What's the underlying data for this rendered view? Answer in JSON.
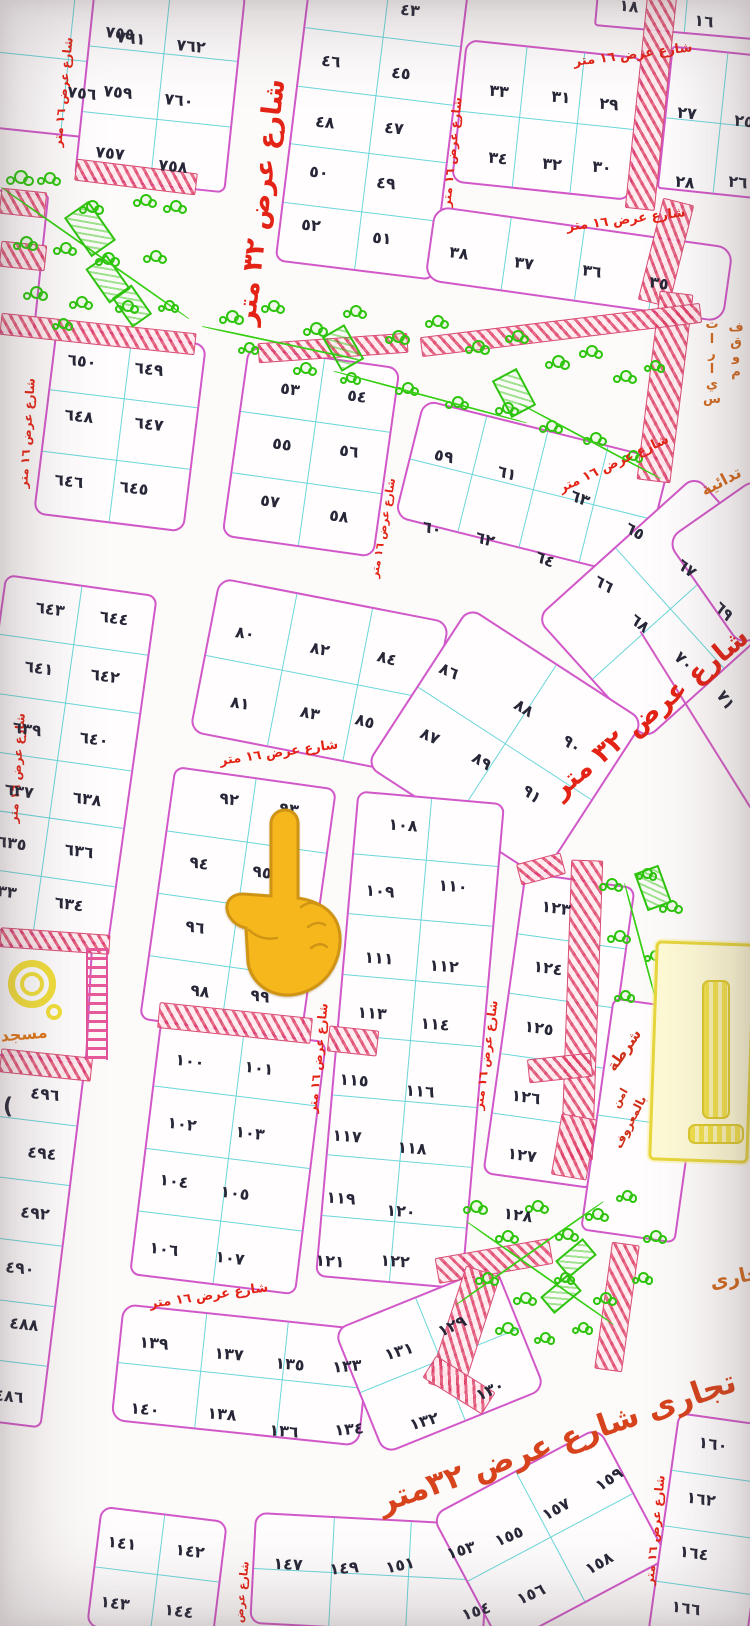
{
  "map": {
    "title": "subdivision-plot-map",
    "colors": {
      "plot_border": "#d158c8",
      "grid_line": "#6bd6da",
      "number": "#272738",
      "street_text": "#e32315",
      "street_text_big": "#d6431c",
      "amenity_text": "#d2691e",
      "hatch": "#de3a62",
      "park_green": "#2ec40e",
      "mosque_yellow": "#f3e03a",
      "hand_yellow": "#f5b71c"
    },
    "hand_icon": {
      "name": "backhand-index-pointing-up",
      "x": 225,
      "y": 806
    },
    "street_labels": [
      {
        "text": "شارع عرض ١٦ متر",
        "x": 63,
        "y": 92,
        "r": -84,
        "size": 12
      },
      {
        "text": "شارع عرض ٣٢ متر",
        "x": 261,
        "y": 202,
        "r": -83,
        "size": 27
      },
      {
        "text": "شارع عرض ١٦ متر",
        "x": 452,
        "y": 152,
        "r": -84,
        "size": 12
      },
      {
        "text": "شارع عرض ١٦ متر",
        "x": 633,
        "y": 55,
        "r": -7,
        "size": 13
      },
      {
        "text": "شارع عرض ١٦ متر",
        "x": 626,
        "y": 220,
        "r": -7,
        "size": 13
      },
      {
        "text": "شارع عرض ١٦ متر",
        "x": 27,
        "y": 433,
        "r": -86,
        "size": 12
      },
      {
        "text": "شارع عرض ١٦ متر",
        "x": 614,
        "y": 464,
        "r": -25,
        "size": 13
      },
      {
        "text": "شارع عرض ١٦ متر",
        "x": 383,
        "y": 528,
        "r": -80,
        "size": 11
      },
      {
        "text": "شارع عرض ٣٢ متر",
        "x": 650,
        "y": 713,
        "r": -40,
        "size": 27
      },
      {
        "text": "شارع عرض ١٦ متر",
        "x": 17,
        "y": 768,
        "r": -86,
        "size": 12
      },
      {
        "text": "شارع عرض ١٦ متر",
        "x": 279,
        "y": 753,
        "r": -8,
        "size": 13
      },
      {
        "text": "شارع عرض ١٦ متر",
        "x": 318,
        "y": 1058,
        "r": -84,
        "size": 12
      },
      {
        "text": "شارع عرض ١٦ متر",
        "x": 486,
        "y": 1055,
        "r": -82,
        "size": 12
      },
      {
        "text": "شارع عرض ١٦ متر",
        "x": 209,
        "y": 1296,
        "r": -8,
        "size": 13
      },
      {
        "text": "شارع عرض",
        "x": 242,
        "y": 1592,
        "r": -84,
        "size": 11
      },
      {
        "text": "شارع عرض ١٦ متر",
        "x": 655,
        "y": 1530,
        "r": -84,
        "size": 12
      },
      {
        "text": "تجارى شارع عرض ٣٢متر",
        "x": 557,
        "y": 1442,
        "r": -19,
        "size": 31,
        "color": "#d6431c"
      }
    ],
    "area_labels": [
      {
        "text": "موقف",
        "x": 736,
        "y": 350,
        "stack": true,
        "size": 13,
        "color": "#d2691e"
      },
      {
        "text": "سيارات",
        "x": 712,
        "y": 362,
        "stack": true,
        "size": 13,
        "color": "#d2691e"
      },
      {
        "text": "تدائية",
        "x": 721,
        "y": 481,
        "r": -28,
        "size": 16,
        "color": "#d2691e"
      },
      {
        "text": "مسجد",
        "x": 24,
        "y": 1034,
        "r": -5,
        "size": 16,
        "color": "#e07818"
      },
      {
        "text": "شرطة",
        "x": 624,
        "y": 1050,
        "r": -55,
        "size": 15,
        "color": "#d03018"
      },
      {
        "text": "امن",
        "x": 620,
        "y": 1098,
        "r": -60,
        "size": 11,
        "color": "#d03018"
      },
      {
        "text": "بالمعروف",
        "x": 630,
        "y": 1122,
        "r": -63,
        "size": 12,
        "color": "#d03018"
      },
      {
        "text": "تجارى",
        "x": 739,
        "y": 1276,
        "r": -12,
        "size": 20,
        "color": "#d2691e"
      },
      {
        "text": "(",
        "x": 8,
        "y": 1107,
        "r": 0,
        "size": 22,
        "color": "#272738"
      }
    ],
    "plots": [
      {
        "label": "٧٥٥",
        "x": 120,
        "y": 33,
        "r": 6
      },
      {
        "label": "٧٥٦",
        "x": 82,
        "y": 93,
        "r": 6
      },
      {
        "label": "٧٦١",
        "x": 131,
        "y": 38,
        "r": 6
      },
      {
        "label": "٧٦٢",
        "x": 191,
        "y": 46,
        "r": 6
      },
      {
        "label": "٧٥٩",
        "x": 118,
        "y": 92,
        "r": 6
      },
      {
        "label": "٧٦٠",
        "x": 179,
        "y": 100,
        "r": 6
      },
      {
        "label": "٧٥٧",
        "x": 110,
        "y": 153,
        "r": 6
      },
      {
        "label": "٧٥٨",
        "x": 173,
        "y": 166,
        "r": 6
      },
      {
        "label": "٤٣",
        "x": 410,
        "y": 10,
        "r": 6
      },
      {
        "label": "٤٥",
        "x": 401,
        "y": 73,
        "r": 6
      },
      {
        "label": "٤٧",
        "x": 394,
        "y": 128,
        "r": 6
      },
      {
        "label": "٤٩",
        "x": 386,
        "y": 183,
        "r": 6
      },
      {
        "label": "٥١",
        "x": 382,
        "y": 238,
        "r": 6
      },
      {
        "label": "٤٦",
        "x": 331,
        "y": 61,
        "r": 6
      },
      {
        "label": "٤٨",
        "x": 325,
        "y": 122,
        "r": 6
      },
      {
        "label": "٥٠",
        "x": 319,
        "y": 172,
        "r": 6
      },
      {
        "label": "٥٢",
        "x": 311,
        "y": 225,
        "r": 6
      },
      {
        "label": "٣٣",
        "x": 499,
        "y": 91,
        "r": 6
      },
      {
        "label": "٣١",
        "x": 561,
        "y": 97,
        "r": 6
      },
      {
        "label": "٢٩",
        "x": 609,
        "y": 104,
        "r": 6
      },
      {
        "label": "٣٤",
        "x": 498,
        "y": 158,
        "r": 6
      },
      {
        "label": "٣٢",
        "x": 552,
        "y": 164,
        "r": 6
      },
      {
        "label": "٣٠",
        "x": 602,
        "y": 167,
        "r": 6
      },
      {
        "label": "٢٧",
        "x": 687,
        "y": 113,
        "r": 6
      },
      {
        "label": "٢٥",
        "x": 744,
        "y": 121,
        "r": 6
      },
      {
        "label": "٢٨",
        "x": 685,
        "y": 182,
        "r": 6
      },
      {
        "label": "٢٦",
        "x": 738,
        "y": 182,
        "r": 6
      },
      {
        "label": "١٨",
        "x": 629,
        "y": 6,
        "r": 6
      },
      {
        "label": "١٦",
        "x": 704,
        "y": 21,
        "r": 6
      },
      {
        "label": "٣٨",
        "x": 459,
        "y": 253,
        "r": 8
      },
      {
        "label": "٣٧",
        "x": 524,
        "y": 263,
        "r": 8
      },
      {
        "label": "٣٦",
        "x": 592,
        "y": 271,
        "r": 8
      },
      {
        "label": "٣٥",
        "x": 659,
        "y": 283,
        "r": 8
      },
      {
        "label": "٦٥٠",
        "x": 82,
        "y": 361,
        "r": 7
      },
      {
        "label": "٦٤٩",
        "x": 149,
        "y": 369,
        "r": 7
      },
      {
        "label": "٦٤٨",
        "x": 79,
        "y": 416,
        "r": 7
      },
      {
        "label": "٦٤٧",
        "x": 149,
        "y": 424,
        "r": 7
      },
      {
        "label": "٦٤٦",
        "x": 69,
        "y": 481,
        "r": 7
      },
      {
        "label": "٦٤٥",
        "x": 134,
        "y": 488,
        "r": 7
      },
      {
        "label": "٥٣",
        "x": 290,
        "y": 389,
        "r": 8
      },
      {
        "label": "٥٤",
        "x": 357,
        "y": 396,
        "r": 8
      },
      {
        "label": "٥٥",
        "x": 282,
        "y": 444,
        "r": 8
      },
      {
        "label": "٥٦",
        "x": 349,
        "y": 451,
        "r": 8
      },
      {
        "label": "٥٧",
        "x": 270,
        "y": 501,
        "r": 8
      },
      {
        "label": "٥٨",
        "x": 339,
        "y": 516,
        "r": 8
      },
      {
        "label": "٥٩",
        "x": 444,
        "y": 456,
        "r": 12
      },
      {
        "label": "٦١",
        "x": 507,
        "y": 473,
        "r": 16
      },
      {
        "label": "٦٣",
        "x": 580,
        "y": 498,
        "r": 22
      },
      {
        "label": "٦٥",
        "x": 635,
        "y": 531,
        "r": 30
      },
      {
        "label": "٦٧",
        "x": 687,
        "y": 568,
        "r": 38
      },
      {
        "label": "٦٩",
        "x": 724,
        "y": 611,
        "r": 45
      },
      {
        "label": "٧١",
        "x": 726,
        "y": 700,
        "r": 55
      },
      {
        "label": "٦٠",
        "x": 432,
        "y": 528,
        "r": 12
      },
      {
        "label": "٦٢",
        "x": 485,
        "y": 539,
        "r": 16
      },
      {
        "label": "٦٤",
        "x": 545,
        "y": 559,
        "r": 22
      },
      {
        "label": "٦٦",
        "x": 604,
        "y": 584,
        "r": 30
      },
      {
        "label": "٦٨",
        "x": 640,
        "y": 623,
        "r": 38
      },
      {
        "label": "٧٠",
        "x": 684,
        "y": 661,
        "r": 45
      },
      {
        "label": "٦٤٣",
        "x": 50,
        "y": 609,
        "r": 8
      },
      {
        "label": "٦٤٤",
        "x": 114,
        "y": 618,
        "r": 8
      },
      {
        "label": "٦٤١",
        "x": 39,
        "y": 668,
        "r": 8
      },
      {
        "label": "٦٤٢",
        "x": 105,
        "y": 676,
        "r": 8
      },
      {
        "label": "٦٣٩",
        "x": 27,
        "y": 729,
        "r": 8
      },
      {
        "label": "٦٤٠",
        "x": 94,
        "y": 739,
        "r": 8
      },
      {
        "label": "٦٣٧",
        "x": 19,
        "y": 791,
        "r": 8
      },
      {
        "label": "٦٣٨",
        "x": 87,
        "y": 799,
        "r": 8
      },
      {
        "label": "٦٣٥",
        "x": 12,
        "y": 843,
        "r": 8
      },
      {
        "label": "٦٣٦",
        "x": 79,
        "y": 851,
        "r": 8
      },
      {
        "label": "٦٣٣",
        "x": 2,
        "y": 891,
        "r": 8
      },
      {
        "label": "٦٣٤",
        "x": 69,
        "y": 904,
        "r": 8
      },
      {
        "label": "٨٠",
        "x": 245,
        "y": 633,
        "r": 8
      },
      {
        "label": "٨٢",
        "x": 320,
        "y": 649,
        "r": 12
      },
      {
        "label": "٨٤",
        "x": 387,
        "y": 658,
        "r": 16
      },
      {
        "label": "٨٦",
        "x": 449,
        "y": 671,
        "r": 24
      },
      {
        "label": "٨٨",
        "x": 524,
        "y": 708,
        "r": 31
      },
      {
        "label": "٩٠",
        "x": 572,
        "y": 744,
        "r": 38
      },
      {
        "label": "٨١",
        "x": 240,
        "y": 703,
        "r": 8
      },
      {
        "label": "٨٣",
        "x": 310,
        "y": 713,
        "r": 12
      },
      {
        "label": "٨٥",
        "x": 365,
        "y": 721,
        "r": 16
      },
      {
        "label": "٨٧",
        "x": 430,
        "y": 736,
        "r": 24
      },
      {
        "label": "٨٩",
        "x": 482,
        "y": 761,
        "r": 31
      },
      {
        "label": "٩١",
        "x": 532,
        "y": 794,
        "r": 38
      },
      {
        "label": "٩٢",
        "x": 229,
        "y": 799,
        "r": 8
      },
      {
        "label": "٩٣",
        "x": 289,
        "y": 809,
        "r": 8
      },
      {
        "label": "٩٤",
        "x": 199,
        "y": 863,
        "r": 8
      },
      {
        "label": "٩٥",
        "x": 262,
        "y": 872,
        "r": 8
      },
      {
        "label": "٩٦",
        "x": 195,
        "y": 927,
        "r": 8
      },
      {
        "label": "٩٧",
        "x": 268,
        "y": 936,
        "r": 8
      },
      {
        "label": "٩٨",
        "x": 200,
        "y": 991,
        "r": 8
      },
      {
        "label": "٩٩",
        "x": 260,
        "y": 996,
        "r": 8
      },
      {
        "label": "١٠٠",
        "x": 190,
        "y": 1061,
        "r": 7
      },
      {
        "label": "١٠١",
        "x": 259,
        "y": 1068,
        "r": 7
      },
      {
        "label": "١٠٢",
        "x": 182,
        "y": 1124,
        "r": 7
      },
      {
        "label": "١٠٣",
        "x": 250,
        "y": 1133,
        "r": 7
      },
      {
        "label": "١٠٤",
        "x": 174,
        "y": 1181,
        "r": 7
      },
      {
        "label": "١٠٥",
        "x": 235,
        "y": 1193,
        "r": 7
      },
      {
        "label": "١٠٦",
        "x": 164,
        "y": 1249,
        "r": 7
      },
      {
        "label": "١٠٧",
        "x": 230,
        "y": 1258,
        "r": 7
      },
      {
        "label": "١٠٨",
        "x": 403,
        "y": 825,
        "r": 4
      },
      {
        "label": "١٠٩",
        "x": 380,
        "y": 891,
        "r": 4
      },
      {
        "label": "١١٠",
        "x": 453,
        "y": 886,
        "r": 4
      },
      {
        "label": "١١١",
        "x": 379,
        "y": 958,
        "r": 4
      },
      {
        "label": "١١٢",
        "x": 444,
        "y": 966,
        "r": 4
      },
      {
        "label": "١١٣",
        "x": 372,
        "y": 1013,
        "r": 4
      },
      {
        "label": "١١٤",
        "x": 435,
        "y": 1024,
        "r": 4
      },
      {
        "label": "١١٥",
        "x": 354,
        "y": 1080,
        "r": 4
      },
      {
        "label": "١١٦",
        "x": 420,
        "y": 1091,
        "r": 4
      },
      {
        "label": "١١٧",
        "x": 347,
        "y": 1136,
        "r": 4
      },
      {
        "label": "١١٨",
        "x": 412,
        "y": 1148,
        "r": 4
      },
      {
        "label": "١١٩",
        "x": 341,
        "y": 1198,
        "r": 4
      },
      {
        "label": "١٢٠",
        "x": 401,
        "y": 1211,
        "r": 4
      },
      {
        "label": "١٢١",
        "x": 330,
        "y": 1261,
        "r": 4
      },
      {
        "label": "١٢٢",
        "x": 395,
        "y": 1261,
        "r": 4
      },
      {
        "label": "١٢٣",
        "x": 556,
        "y": 908,
        "r": 8
      },
      {
        "label": "١٢٤",
        "x": 548,
        "y": 968,
        "r": 8
      },
      {
        "label": "١٢٥",
        "x": 539,
        "y": 1028,
        "r": 8
      },
      {
        "label": "١٢٦",
        "x": 526,
        "y": 1097,
        "r": 8
      },
      {
        "label": "١٢٧",
        "x": 522,
        "y": 1155,
        "r": 8
      },
      {
        "label": "١٢٨",
        "x": 518,
        "y": 1215,
        "r": 8
      },
      {
        "label": "٤٩٦",
        "x": 45,
        "y": 1094,
        "r": 6
      },
      {
        "label": "٤٩٤",
        "x": 42,
        "y": 1153,
        "r": 6
      },
      {
        "label": "٤٩٢",
        "x": 35,
        "y": 1213,
        "r": 6
      },
      {
        "label": "٤٩٠",
        "x": 20,
        "y": 1268,
        "r": 6
      },
      {
        "label": "٤٨٨",
        "x": 24,
        "y": 1324,
        "r": 6
      },
      {
        "label": "٤٨٦",
        "x": 9,
        "y": 1396,
        "r": 6
      },
      {
        "label": "١٣٩",
        "x": 154,
        "y": 1343,
        "r": 5
      },
      {
        "label": "١٣٧",
        "x": 229,
        "y": 1354,
        "r": 5
      },
      {
        "label": "١٣٥",
        "x": 290,
        "y": 1364,
        "r": 5
      },
      {
        "label": "١٣٣",
        "x": 347,
        "y": 1366,
        "r": -5
      },
      {
        "label": "١٣١",
        "x": 399,
        "y": 1351,
        "r": -16
      },
      {
        "label": "١٢٩",
        "x": 452,
        "y": 1326,
        "r": -25
      },
      {
        "label": "١٤٠",
        "x": 145,
        "y": 1409,
        "r": 5
      },
      {
        "label": "١٣٨",
        "x": 222,
        "y": 1414,
        "r": 5
      },
      {
        "label": "١٣٦",
        "x": 284,
        "y": 1431,
        "r": 5
      },
      {
        "label": "١٣٤",
        "x": 349,
        "y": 1429,
        "r": -5
      },
      {
        "label": "١٣٢",
        "x": 424,
        "y": 1421,
        "r": -16
      },
      {
        "label": "١٣٠",
        "x": 490,
        "y": 1390,
        "r": -25
      },
      {
        "label": "١٤١",
        "x": 122,
        "y": 1543,
        "r": 7
      },
      {
        "label": "١٤٢",
        "x": 190,
        "y": 1551,
        "r": 7
      },
      {
        "label": "١٤٣",
        "x": 115,
        "y": 1603,
        "r": 7
      },
      {
        "label": "١٤٤",
        "x": 179,
        "y": 1611,
        "r": 7
      },
      {
        "label": "١٤٧",
        "x": 288,
        "y": 1564,
        "r": 3
      },
      {
        "label": "١٤٩",
        "x": 344,
        "y": 1568,
        "r": -5
      },
      {
        "label": "١٥١",
        "x": 400,
        "y": 1565,
        "r": -12
      },
      {
        "label": "١٥٣",
        "x": 461,
        "y": 1550,
        "r": -17
      },
      {
        "label": "١٥٥",
        "x": 509,
        "y": 1536,
        "r": -23
      },
      {
        "label": "١٥٧",
        "x": 556,
        "y": 1509,
        "r": -29
      },
      {
        "label": "١٥٩",
        "x": 609,
        "y": 1479,
        "r": -34
      },
      {
        "label": "١٥٤",
        "x": 476,
        "y": 1611,
        "r": -18
      },
      {
        "label": "١٥٦",
        "x": 531,
        "y": 1594,
        "r": -24
      },
      {
        "label": "١٥٨",
        "x": 599,
        "y": 1563,
        "r": -30
      },
      {
        "label": "١٦٠",
        "x": 713,
        "y": 1444,
        "r": 8
      },
      {
        "label": "١٦٢",
        "x": 701,
        "y": 1499,
        "r": 8
      },
      {
        "label": "١٦٤",
        "x": 694,
        "y": 1553,
        "r": 8
      },
      {
        "label": "١٦٦",
        "x": 686,
        "y": 1608,
        "r": 8
      }
    ]
  }
}
